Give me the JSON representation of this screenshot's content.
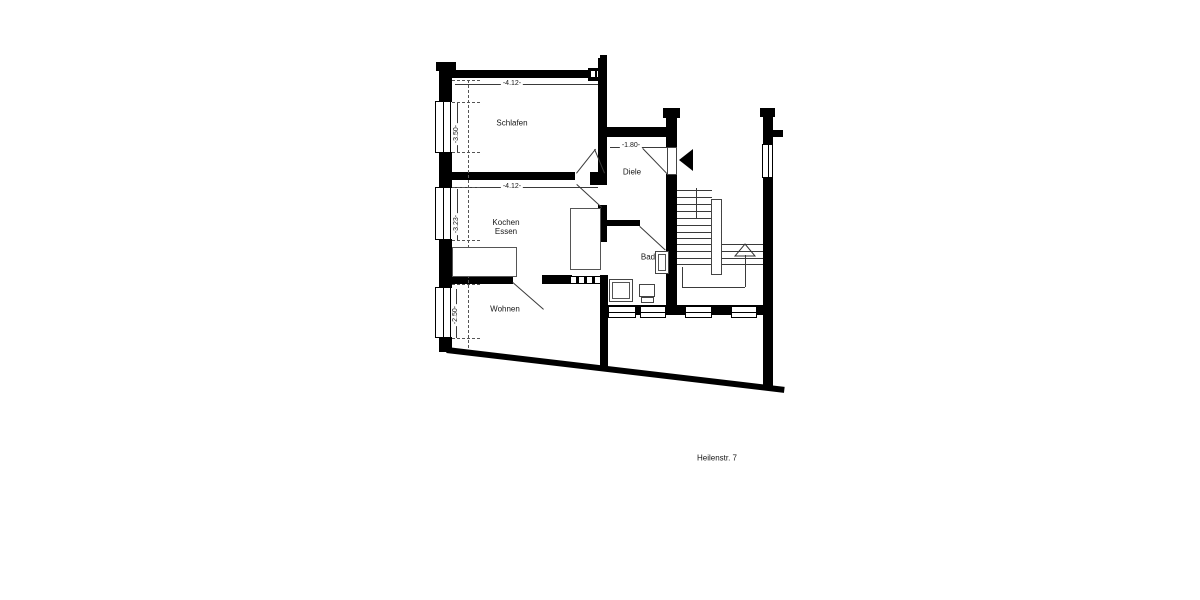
{
  "plan": {
    "address": "Heilenstr. 7",
    "rooms": [
      {
        "id": "schlafen",
        "label": "Schlafen"
      },
      {
        "id": "kochen_essen",
        "label_line1": "Kochen",
        "label_line2": "Essen"
      },
      {
        "id": "wohnen",
        "label": "Wohnen"
      },
      {
        "id": "diele",
        "label": "Diele"
      },
      {
        "id": "bad",
        "label": "Bad"
      }
    ],
    "dimensions": {
      "schlafen_width": "-4.12-",
      "kochen_width": "-4.12-",
      "entry_width": "-1.80-",
      "schlafen_depth": "-3.50-",
      "kochen_depth": "-3.23-",
      "wohnen_depth": "-2.50-"
    },
    "icons": {
      "entrance": "entrance-arrow",
      "stair_direction": "stair-up-arrow"
    },
    "colors": {
      "wall": "#000000",
      "background": "#ffffff",
      "thin_line": "#3a3a3a"
    }
  }
}
